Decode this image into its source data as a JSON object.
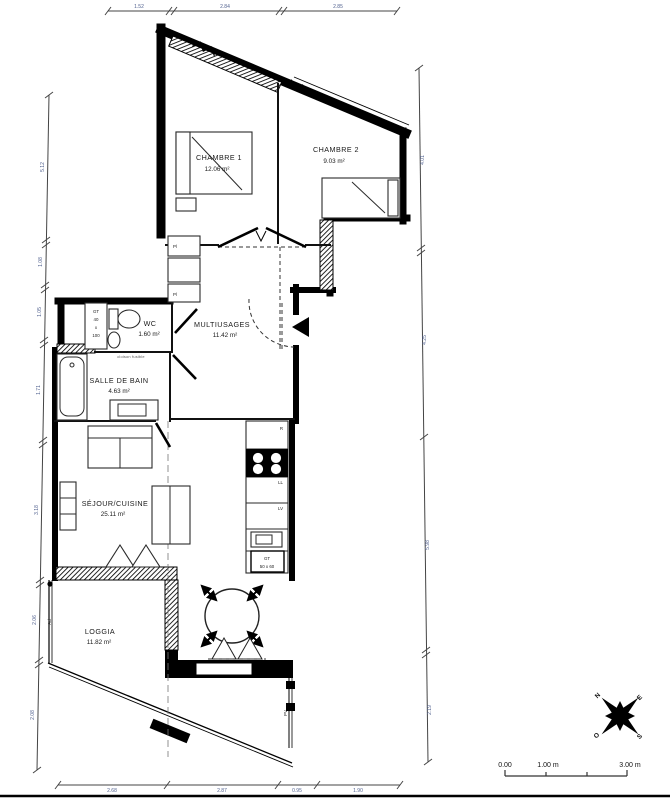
{
  "rooms": [
    {
      "name": "CHAMBRE 1",
      "area": "12.06 m²"
    },
    {
      "name": "CHAMBRE 2",
      "area": "9.03 m²"
    },
    {
      "name": "WC",
      "area": "1.60 m²"
    },
    {
      "name": "MULTIUSAGES",
      "area": "11.42 m²"
    },
    {
      "name": "SALLE DE BAIN",
      "area": "4.63 m²"
    },
    {
      "name": "SÉJOUR/CUISINE",
      "area": "25.11 m²"
    },
    {
      "name": "LOGGIA",
      "area": "11.82 m²"
    }
  ],
  "dimensions": {
    "top": [
      "1.52",
      "2.84",
      "2.85"
    ],
    "bottom": [
      "2.68",
      "2.87",
      "0.95",
      "1.90"
    ],
    "left": [
      "5.12",
      "1.08",
      "1.05",
      "1.71",
      "3.18",
      "2.06",
      "2.08"
    ],
    "right": [
      "4.01",
      "4.25",
      "5.98",
      "2.19"
    ]
  },
  "labels": {
    "shaft_gt_line1": "GT",
    "shaft_gt_line2": "40",
    "shaft_gt_line3": "x",
    "shaft_gt_line4": "100",
    "partition_note": "cloison fusible",
    "kitchen_gt_line1": "GT",
    "kitchen_gt_line2": "50 x 60",
    "fridge": "R",
    "washing_machine": "LL",
    "dishwasher": "LV",
    "pv": "PV",
    "ad": "Ad",
    "closet": "Pl"
  },
  "compass": {
    "n": "N",
    "e": "E",
    "s": "S",
    "o": "O"
  },
  "scalebar": {
    "zero": "0.00",
    "one": "1.00 m",
    "three": "3.00 m"
  }
}
